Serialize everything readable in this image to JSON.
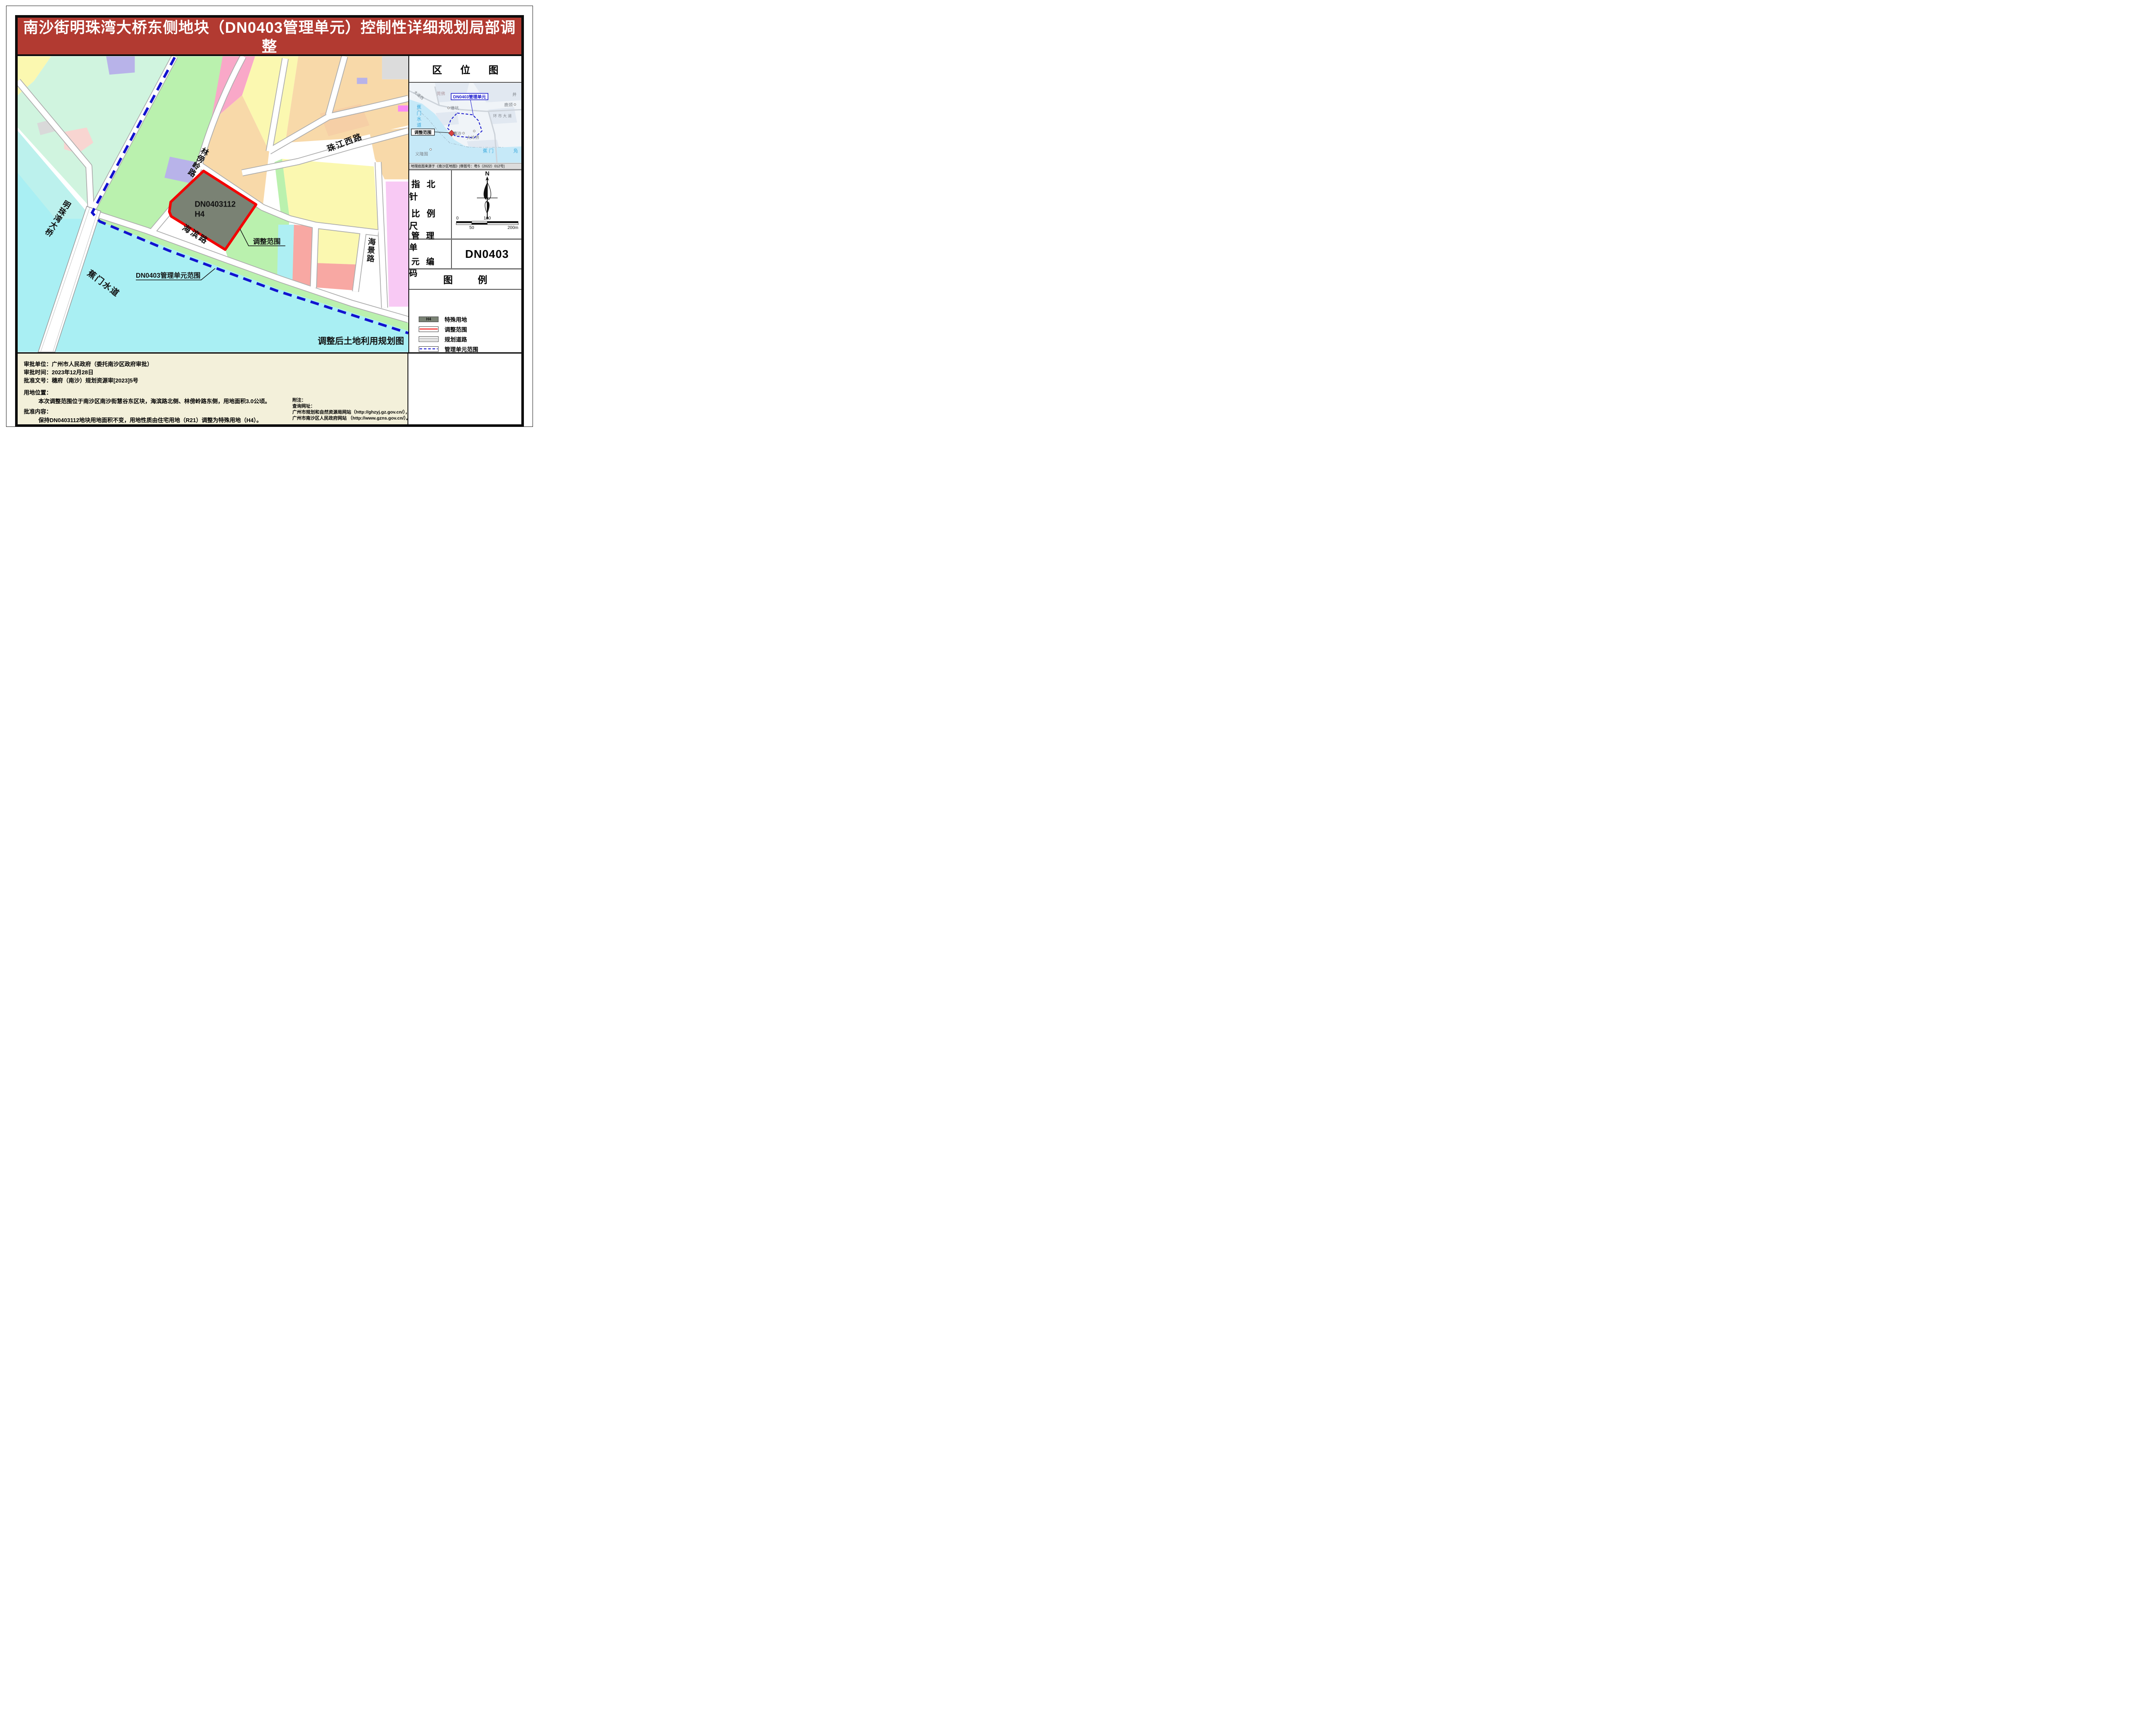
{
  "title": {
    "line1": "南沙街明珠湾大桥东侧地块（DN0403管理单元）控制性详细规划局部调整",
    "line2": "批后通告图"
  },
  "colors": {
    "title_bg": "#b23a31",
    "water": "#a9eff3",
    "h4_parcel": "#7a8274",
    "adjust_red": "#f20000",
    "boundary_blue": "#1212cf",
    "notes_bg": "#f3f0da"
  },
  "map": {
    "labels": {
      "parcel_code": "DN0403112",
      "parcel_use": "H4",
      "adjust_scope": "调整范围",
      "unit_scope": "DN0403管理单元范围",
      "caption": "调整后土地利用规划图",
      "water": "蕉门水道",
      "bridge": "明珠湾大桥",
      "road_linbangling": "林傍岭路",
      "road_haibin": "海滨路",
      "road_zhujiangxi": "珠江西路",
      "road_haijing": "海景路"
    }
  },
  "sidebar": {
    "location": {
      "title": "区 位 图",
      "unit_label": "DN0403管理单元",
      "adjust_label": "调整范围",
      "places": {
        "tangkeng": "塘坑",
        "lujing": "鹿颈",
        "nansha": "南沙",
        "dalingjie": "大岭界",
        "yilongwei": "义隆围",
        "huanshi": "环 市 大 道",
        "jiaomen": "蕉 门",
        "fu": "凫",
        "jing": "井",
        "guanfo": "莞佛",
        "dadaoxi": "大道西",
        "channel": "蕉门水道"
      },
      "source": "地理底图来源于《南沙区地图》[审图号：粤S（2022）012号]"
    },
    "compass": {
      "label_line1": "指 北 针",
      "label_line2": "比 例 尺",
      "north_label": "N",
      "scale": {
        "t0": "0",
        "t100": "100",
        "t50": "50",
        "t200": "200m"
      }
    },
    "unit_code": {
      "label_line1": "管 理 单",
      "label_line2": "元 编 码",
      "value": "DN0403"
    },
    "legend": {
      "title": "图 例",
      "items": [
        {
          "swatch": "h4",
          "swatch_label": "H4",
          "label": "特殊用地"
        },
        {
          "swatch": "red-line",
          "label": "调整范围"
        },
        {
          "swatch": "road",
          "label": "规划道路"
        },
        {
          "swatch": "blue-dash",
          "label": "管理单元范围"
        }
      ]
    }
  },
  "notes": {
    "approval_unit": "审批单位：广州市人民政府（委托南沙区政府审批）",
    "approval_time": "审批时间：2023年12月28日",
    "approval_doc": "批准文号：穗府（南沙）规划资源审[2023]5号",
    "location_title": "用地位置：",
    "location_body": "本次调整范围位于南沙区南沙街慧谷东区块，海滨路北侧、林傍岭路东侧，用地面积3.0公顷。",
    "content_title": "批准内容：",
    "content_body": "保持DN0403112地块用地面积不变，用地性质由住宅用地（R21）调整为特殊用地（H4）。",
    "notes_title": "附注：",
    "notes_line1": "查询网址：",
    "notes_line2": "广州市规划和自然资源局网站（http://ghzyj.gz.gov.cn/），",
    "notes_line3": "广州市南沙区人民政府网站 （http://www.gzns.gov.cn/）。"
  }
}
